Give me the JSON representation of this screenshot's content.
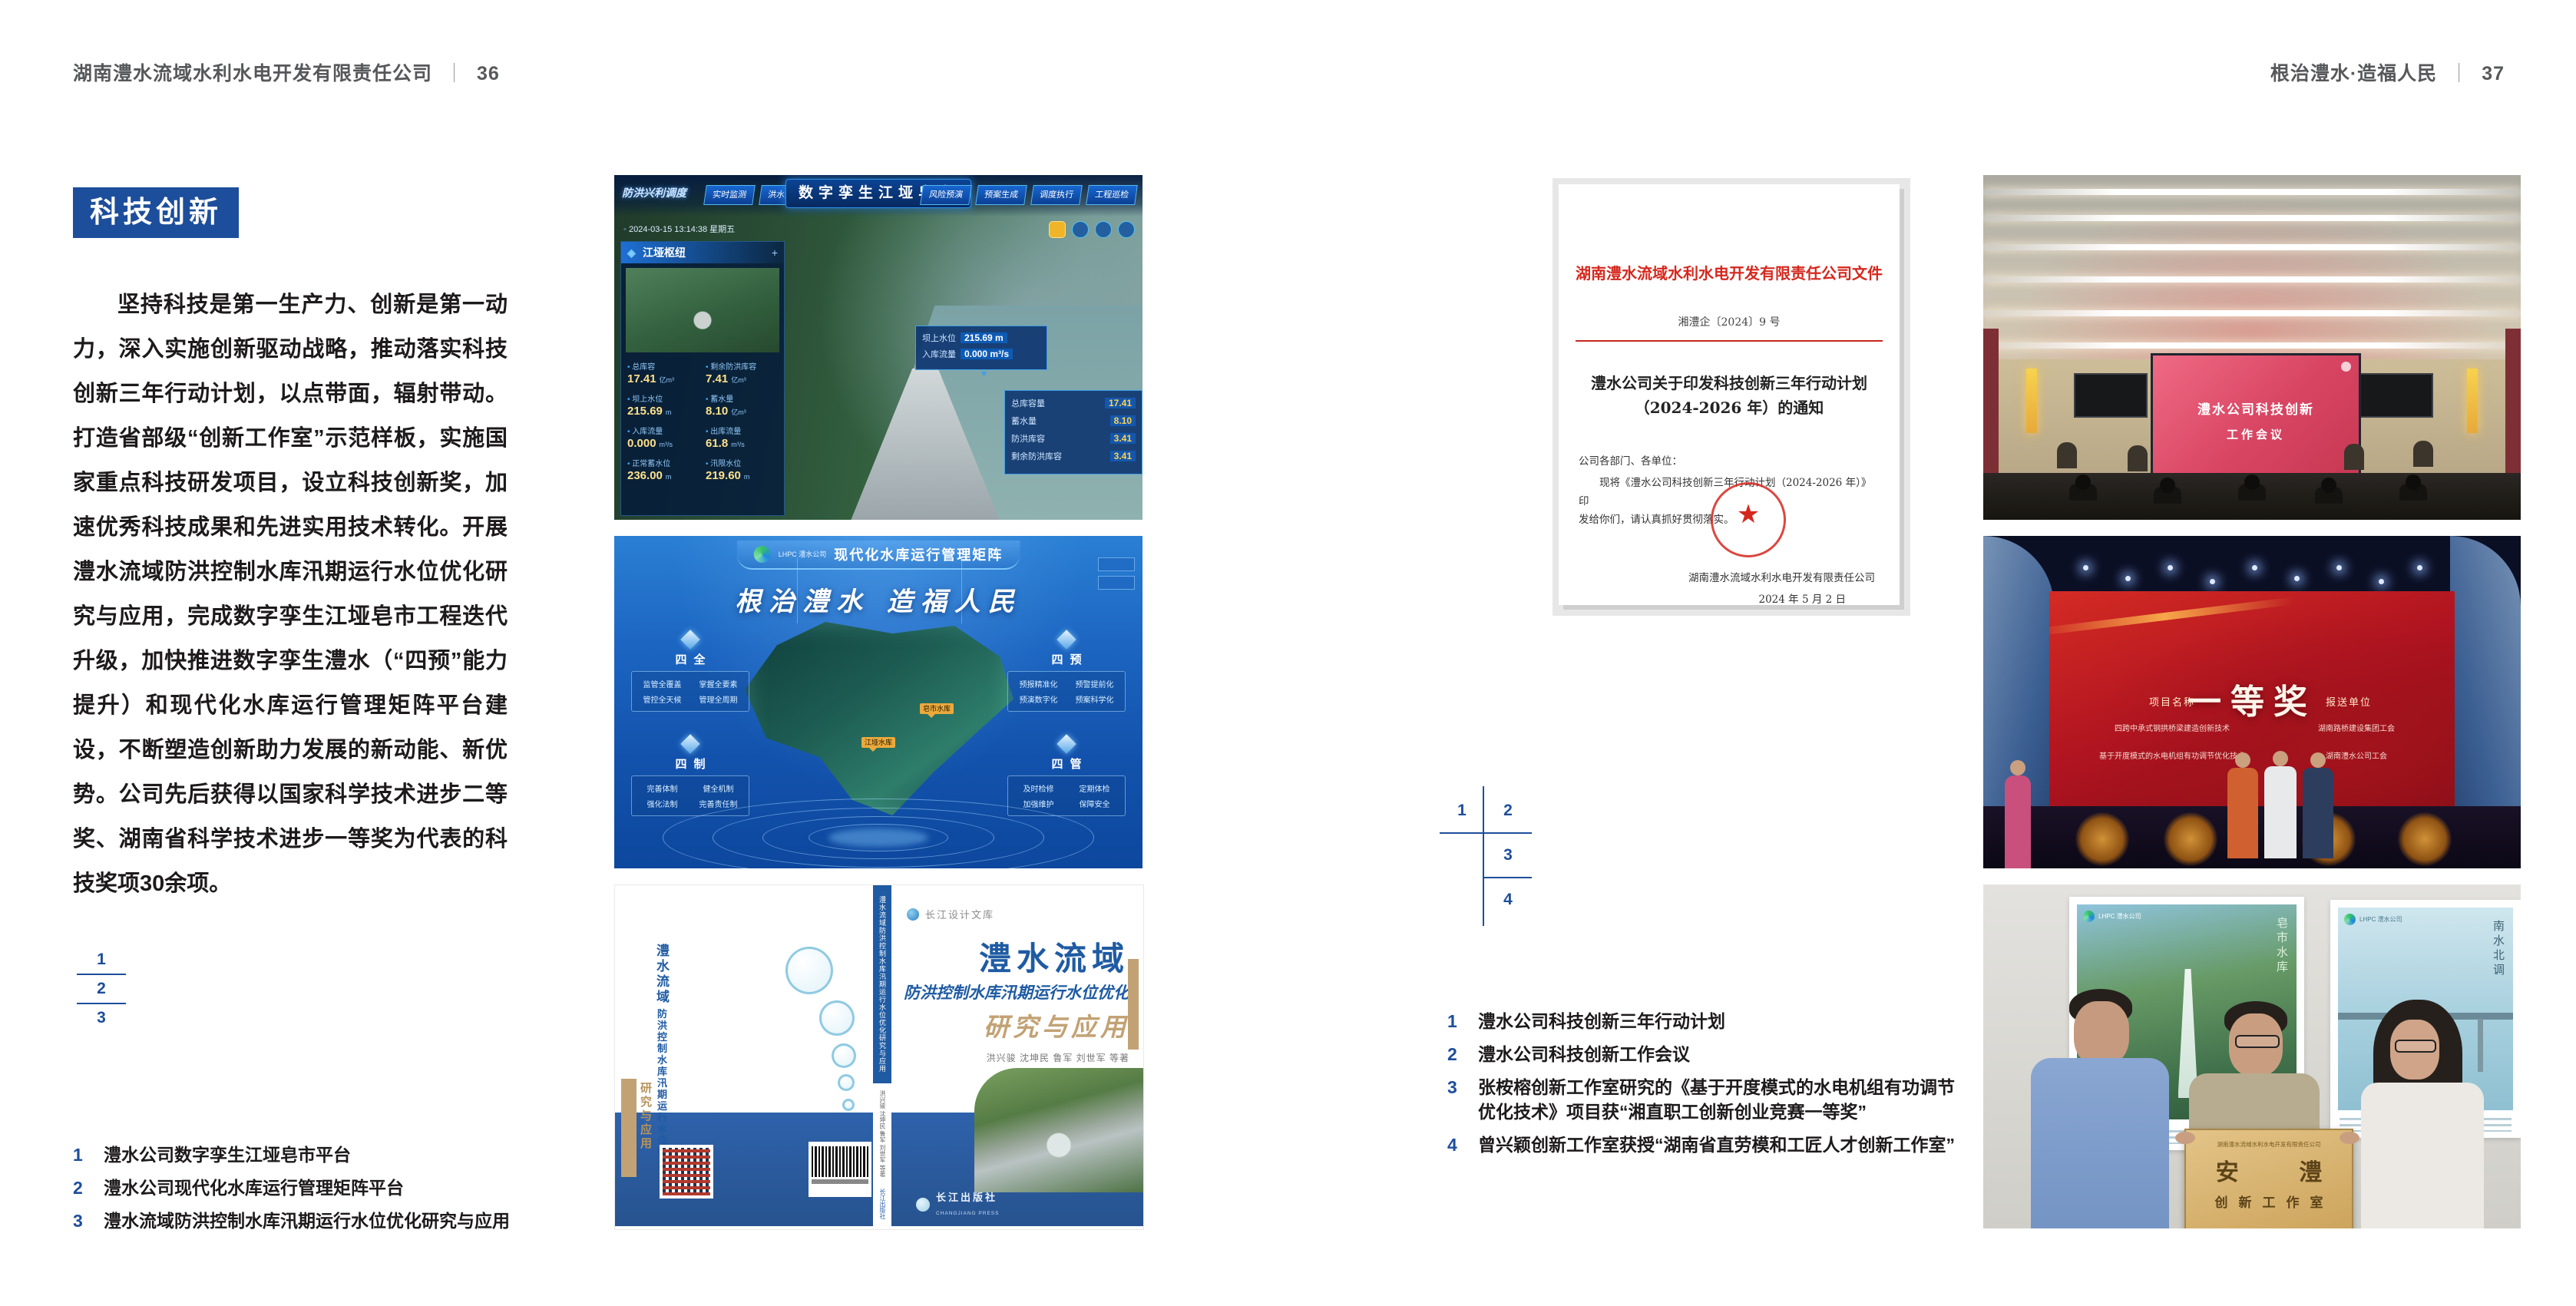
{
  "header_left": {
    "company": "湖南澧水流域水利水电开发有限责任公司",
    "divider": "｜",
    "page": "36"
  },
  "header_right": {
    "slogan": "根治澧水·造福人民",
    "divider": "｜",
    "page": "37"
  },
  "left_page": {
    "section_title": "科技创新",
    "body": "坚持科技是第一生产力、创新是第一动力，深入实施创新驱动战略，推动落实科技创新三年行动计划，以点带面，辐射带动。打造省部级“创新工作室”示范样板，实施国家重点科技研发项目，设立科技创新奖，加速优秀科技成果和先进实用技术转化。开展澧水流域防洪控制水库汛期运行水位优化研究与应用，完成数字孪生江垭皂市工程迭代升级，加快推进数字孪生澧水（“四预”能力提升）和现代化水库运行管理矩阵平台建设，不断塑造创新助力发展的新动能、新优势。公司先后获得以国家科学技术进步二等奖、湖南省科学技术进步一等奖为代表的科技奖项30余项。",
    "index_numbers": [
      "1",
      "2",
      "3"
    ],
    "captions": [
      {
        "num": "1",
        "text": "澧水公司数字孪生江垭皂市平台"
      },
      {
        "num": "2",
        "text": "澧水公司现代化水库运行管理矩阵平台"
      },
      {
        "num": "3",
        "text": "澧水流域防洪控制水库汛期运行水位优化研究与应用"
      }
    ]
  },
  "right_page": {
    "index_numbers": [
      "1",
      "2",
      "3",
      "4"
    ],
    "captions": [
      {
        "num": "1",
        "text": "澧水公司科技创新三年行动计划"
      },
      {
        "num": "2",
        "text": "澧水公司科技创新工作会议"
      },
      {
        "num": "3",
        "text": "张桉榕创新工作室研究的《基于开度模式的水电机组有功调节优化技术》项目获“湘直职工创新创业竞赛一等奖”"
      },
      {
        "num": "4",
        "text": "曾兴颖创新工作室获授“湖南省直劳模和工匠人才创新工作室”"
      }
    ]
  },
  "fig_digital_twin": {
    "title": "数字孪生江垭皂市",
    "module_label": "防洪兴利调度",
    "tabs_left": [
      "实时监测",
      "洪水预报",
      "防洪预警"
    ],
    "tabs_right": [
      "风险预演",
      "预案生成",
      "调度执行",
      "工程巡检"
    ],
    "timestamp": "2024-03-15 13:14:38 星期五",
    "panel_title": "江垭枢纽",
    "stats": [
      {
        "label": "总库容",
        "value": "17.41",
        "unit": "亿m³"
      },
      {
        "label": "剩余防洪库容",
        "value": "7.41",
        "unit": "亿m³"
      },
      {
        "label": "坝上水位",
        "value": "215.69",
        "unit": "m"
      },
      {
        "label": "蓄水量",
        "value": "8.10",
        "unit": "亿m³"
      },
      {
        "label": "入库流量",
        "value": "0.000",
        "unit": "m³/s"
      },
      {
        "label": "出库流量",
        "value": "61.8",
        "unit": "m³/s"
      },
      {
        "label": "正常蓄水位",
        "value": "236.00",
        "unit": "m"
      },
      {
        "label": "汛限水位",
        "value": "219.60",
        "unit": "m"
      }
    ],
    "tooltip": [
      {
        "label": "坝上水位",
        "value": "215.69 m"
      },
      {
        "label": "入库流量",
        "value": "0.000 m³/s"
      }
    ],
    "info_panel": [
      {
        "label": "总库容量",
        "value": "17.41"
      },
      {
        "label": "蓄水量",
        "value": "8.10"
      },
      {
        "label": "防洪库容",
        "value": "3.41"
      },
      {
        "label": "剩余防洪库容",
        "value": "3.41"
      }
    ]
  },
  "fig_matrix": {
    "logo_text": "LHPC 澧水公司",
    "title": "现代化水库运行管理矩阵",
    "slogan": "根治澧水 造福人民",
    "quadrants": [
      {
        "name": "四全",
        "items": [
          "监管全覆盖",
          "掌握全要素",
          "管控全天候",
          "管理全周期"
        ]
      },
      {
        "name": "四预",
        "items": [
          "预报精准化",
          "预警提前化",
          "预演数字化",
          "预案科学化"
        ]
      },
      {
        "name": "四制",
        "items": [
          "完善体制",
          "健全机制",
          "强化法制",
          "完善责任制"
        ]
      },
      {
        "name": "四管",
        "items": [
          "及时检修",
          "定期体检",
          "加强维护",
          "保障安全"
        ]
      }
    ],
    "markers": [
      "皂市水库",
      "江垭水库"
    ]
  },
  "fig_book": {
    "series": "长江设计文库",
    "title": "澧水流域",
    "subtitle": "防洪控制水库汛期运行水位优化",
    "subtitle2": "研究与应用",
    "authors": "洪兴骏 沈坤民 鲁军 刘世军 等著",
    "spine": "澧水流域防洪控制水库汛期运行水位优化研究与应用",
    "publisher": "长江出版社",
    "publisher_en": "CHANGJIANG PRESS"
  },
  "fig_document": {
    "header": "湖南澧水流域水利水电开发有限责任公司文件",
    "doc_number": "湘澧企〔2024〕9 号",
    "title_line1": "澧水公司关于印发科技创新三年行动计划",
    "title_line2": "（2024-2026 年）的通知",
    "salutation": "公司各部门、各单位：",
    "body_line1": "现将《澧水公司科技创新三年行动计划（2024-2026 年）》印",
    "body_line2": "发给你们，请认真抓好贯彻落实。",
    "signature": "湖南澧水流域水利水电开发有限责任公司",
    "date": "2024 年 5 月 2 日"
  },
  "fig_meeting": {
    "screen_line1": "澧水公司科技创新",
    "screen_line2": "工作会议"
  },
  "fig_award": {
    "title": "一等奖",
    "col_project": "项目名称",
    "col_org": "报送单位",
    "rows": [
      {
        "project": "四跨中承式钢拱桥梁建造创新技术",
        "org": "湖南路桥建设集团工会"
      },
      {
        "project": "基于开度模式的水电机组有功调节优化技术",
        "org": "湖南澧水公司工会"
      }
    ]
  },
  "fig_group": {
    "poster_left_logo": "LHPC 澧水公司",
    "poster_left_caption": "皂市水库",
    "poster_right_logo": "LHPC 澧水公司",
    "poster_right_caption": "南水北调",
    "plaque_org": "湖南澧水流域水利水电开发有限责任公司",
    "plaque_main": "安 澧",
    "plaque_sub": "创新工作室"
  }
}
